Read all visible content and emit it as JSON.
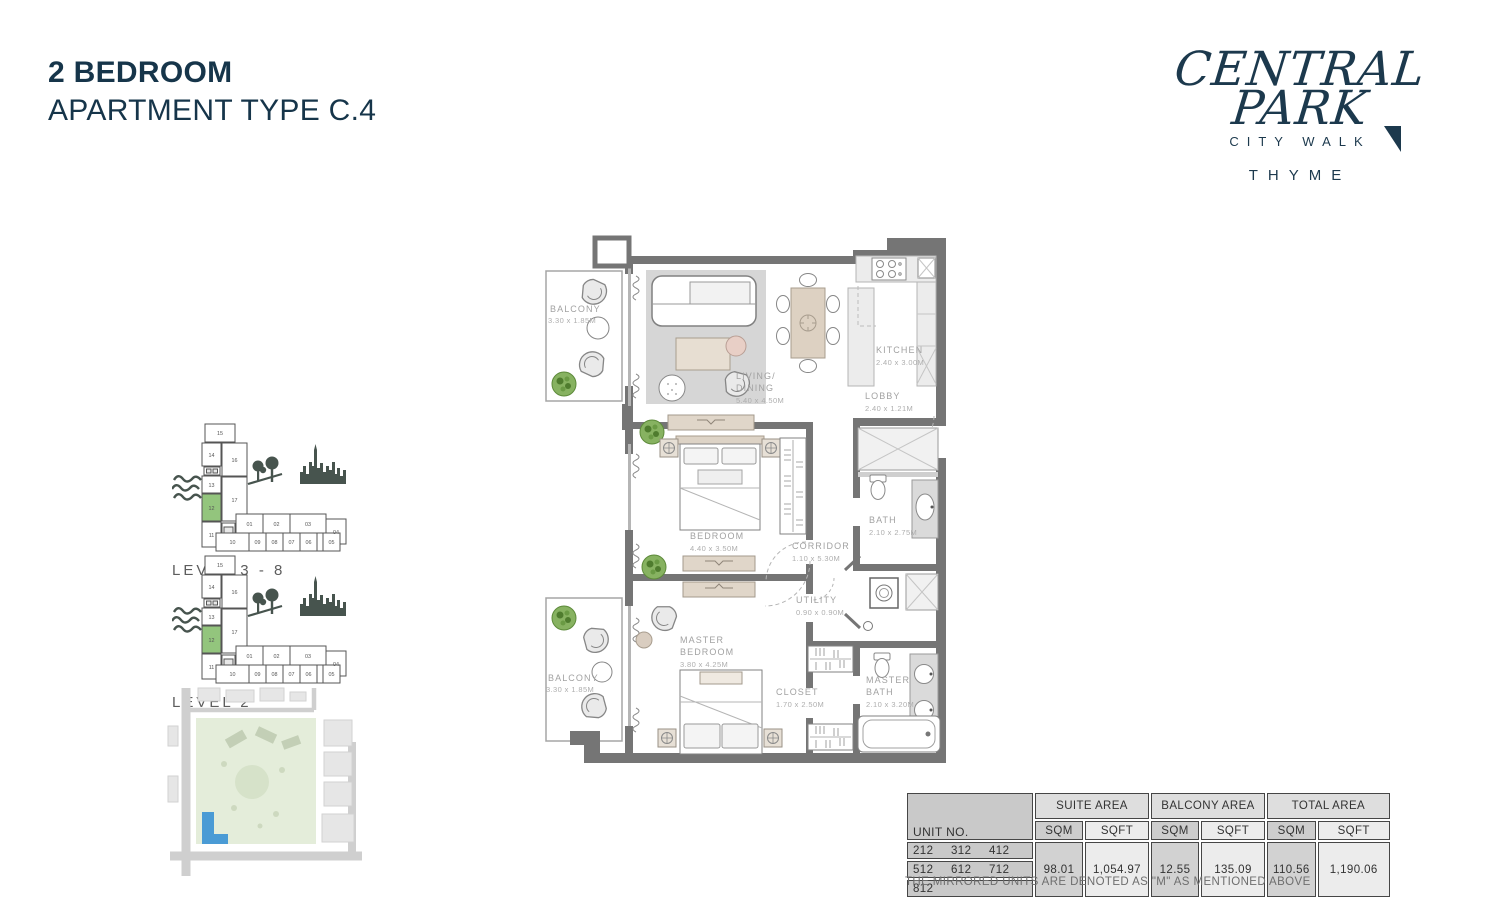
{
  "page": {
    "title_line1": "2 BEDROOM",
    "title_line2": "APARTMENT TYPE C.4",
    "note": "THE MIRRORED UNITS ARE DENOTED AS \"M\" AS MENTIONED ABOVE"
  },
  "logo": {
    "line1": "CENTRAL",
    "line2": "PARK",
    "subtitle": "CITY WALK",
    "brand": "THYME"
  },
  "key_plans": {
    "units": [
      "01",
      "02",
      "03",
      "04",
      "05",
      "06",
      "07",
      "08",
      "09",
      "10",
      "11",
      "12",
      "13",
      "14",
      "15",
      "16",
      "17"
    ],
    "highlighted_unit": "12",
    "level_a_label": "LEVEL  3 - 8",
    "level_b_label": "LEVEL  2"
  },
  "floor_plan": {
    "rooms": {
      "balcony_top": {
        "name": "BALCONY",
        "dims": "3.30 x 1.85M"
      },
      "living_dining": {
        "l1": "LIVING/",
        "l2": "DINING",
        "dims": "5.40 x 4.50M"
      },
      "kitchen": {
        "name": "KITCHEN",
        "dims": "2.40 x 3.00M"
      },
      "lobby": {
        "name": "LOBBY",
        "dims": "2.40 x 1.21M"
      },
      "bedroom": {
        "name": "BEDROOM",
        "dims": "4.40 x 3.50M"
      },
      "bath": {
        "name": "BATH",
        "dims": "2.10 x 2.75M"
      },
      "corridor": {
        "name": "CORRIDOR",
        "dims": "1.10 x 5.30M"
      },
      "utility": {
        "name": "UTILITY",
        "dims": "0.90 x 0.90M"
      },
      "master_bedroom": {
        "l1": "MASTER",
        "l2": "BEDROOM",
        "dims": "3.80 x 4.25M"
      },
      "closet": {
        "name": "CLOSET",
        "dims": "1.70 x 2.50M"
      },
      "master_bath": {
        "l1": "MASTER",
        "l2": "BATH",
        "dims": "2.10 x 3.20M"
      },
      "balcony_bottom": {
        "name": "BALCONY",
        "dims": "3.30 x 1.85M"
      }
    }
  },
  "table": {
    "col_unit": "UNIT NO.",
    "groups": [
      "SUITE AREA",
      "BALCONY AREA",
      "TOTAL AREA"
    ],
    "sub": {
      "sqm": "SQM",
      "sqft": "SQFT"
    },
    "unit_rows": [
      [
        "212",
        "312",
        "412"
      ],
      [
        "512",
        "612",
        "712"
      ],
      [
        "812"
      ]
    ],
    "values": {
      "suite_sqm": "98.01",
      "suite_sqft": "1,054.97",
      "balcony_sqm": "12.55",
      "balcony_sqft": "135.09",
      "total_sqm": "110.56",
      "total_sqft": "1,190.06"
    }
  },
  "colors": {
    "navy": "#1c394d",
    "wall_gray": "#757575",
    "highlight_green": "#93c57d",
    "site_blue": "#4a9bd5"
  }
}
